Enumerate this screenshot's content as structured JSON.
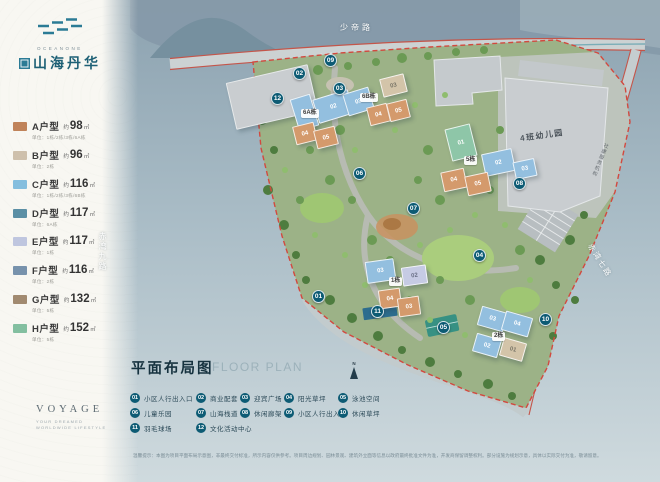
{
  "brand": {
    "logo_en": "OCEANONE",
    "logo_cn": "山海丹华",
    "tagline": "VOYAGE",
    "tagline_sub1": "YOUR DREAMED",
    "tagline_sub2": "WORLDWIDE LIFESTYLE"
  },
  "legend": {
    "units": [
      {
        "label": "A户型",
        "approx": "约",
        "area": "98",
        "unit": "㎡",
        "note": "单位：1栋/2栋/3栋/6A栋",
        "color": "#c0835a"
      },
      {
        "label": "B户型",
        "approx": "约",
        "area": "96",
        "unit": "㎡",
        "note": "单位：2栋",
        "color": "#cec0ac"
      },
      {
        "label": "C户型",
        "approx": "约",
        "area": "116",
        "unit": "㎡",
        "note": "单位：1栋/2栋/3栋/6B栋",
        "color": "#85bede"
      },
      {
        "label": "D户型",
        "approx": "约",
        "area": "117",
        "unit": "㎡",
        "note": "单位：6A栋",
        "color": "#5b8fa5"
      },
      {
        "label": "E户型",
        "approx": "约",
        "area": "117",
        "unit": "㎡",
        "note": "单位：1栋",
        "color": "#bfc6df"
      },
      {
        "label": "F户型",
        "approx": "约",
        "area": "116",
        "unit": "㎡",
        "note": "单位：2栋",
        "color": "#7792ac"
      },
      {
        "label": "G户型",
        "approx": "约",
        "area": "132",
        "unit": "㎡",
        "note": "单位：5栋",
        "color": "#a18a70"
      },
      {
        "label": "H户型",
        "approx": "约",
        "area": "152",
        "unit": "㎡",
        "note": "单位：5栋",
        "color": "#83bfa0"
      }
    ]
  },
  "map": {
    "roads": {
      "top": "少帝路",
      "left": "赤湾九路",
      "right": "赤湾七路"
    },
    "labels": {
      "b6a": "6A栋",
      "b6b": "6B栋",
      "b5": "5栋",
      "b1": "1栋",
      "b2": "2栋",
      "kindergarten": "4班幼儿园",
      "service": "社康服务机构"
    },
    "units": [
      {
        "num": "01"
      },
      {
        "num": "02"
      },
      {
        "num": "03"
      },
      {
        "num": "03"
      },
      {
        "num": "04"
      },
      {
        "num": "05"
      },
      {
        "num": "04"
      },
      {
        "num": "05"
      },
      {
        "num": "01"
      },
      {
        "num": "02"
      },
      {
        "num": "03"
      },
      {
        "num": "04"
      },
      {
        "num": "05"
      },
      {
        "num": "03"
      },
      {
        "num": "02"
      },
      {
        "num": "04"
      },
      {
        "num": "03"
      },
      {
        "num": "03"
      },
      {
        "num": "04"
      },
      {
        "num": "02"
      },
      {
        "num": "01"
      }
    ],
    "markers": [
      {
        "num": "01"
      },
      {
        "num": "02"
      },
      {
        "num": "03"
      },
      {
        "num": "04"
      },
      {
        "num": "05"
      },
      {
        "num": "06"
      },
      {
        "num": "07"
      },
      {
        "num": "08"
      },
      {
        "num": "09"
      },
      {
        "num": "10"
      },
      {
        "num": "11"
      },
      {
        "num": "12"
      }
    ]
  },
  "floorplan": {
    "title": "平面布局图",
    "title_en": "FLOOR PLAN",
    "north": "N",
    "items": [
      {
        "num": "01",
        "label": "小区人行出入口"
      },
      {
        "num": "02",
        "label": "商业配套"
      },
      {
        "num": "03",
        "label": "迎宾广场"
      },
      {
        "num": "04",
        "label": "阳光草坪"
      },
      {
        "num": "05",
        "label": "泳池空间"
      },
      {
        "num": "06",
        "label": "儿童乐园"
      },
      {
        "num": "07",
        "label": "山海栈道"
      },
      {
        "num": "08",
        "label": "休闲廊架"
      },
      {
        "num": "09",
        "label": "小区人行出入口"
      },
      {
        "num": "10",
        "label": "休闲草坪"
      },
      {
        "num": "11",
        "label": "羽毛球场"
      },
      {
        "num": "12",
        "label": "文化活动中心"
      }
    ],
    "disclaimer": "温馨提示：本图为项目平面布局示意图，非最终交付标准，所示内容仅供参考。项目周边规划、园林景观、建筑外立面等信息以政府最终批准文件为准，开发商保留调整权利。部分设施为规划示意，具体以实际交付为准，敬请留意。"
  },
  "colors": {
    "accent_teal": "#0d5b74",
    "brand_teal": "#2b7b95",
    "boundary_red": "#d2493f",
    "panel_bg": "#f8f7f2",
    "water_top": "#8ca2b0",
    "water_bottom": "#cfdade"
  }
}
